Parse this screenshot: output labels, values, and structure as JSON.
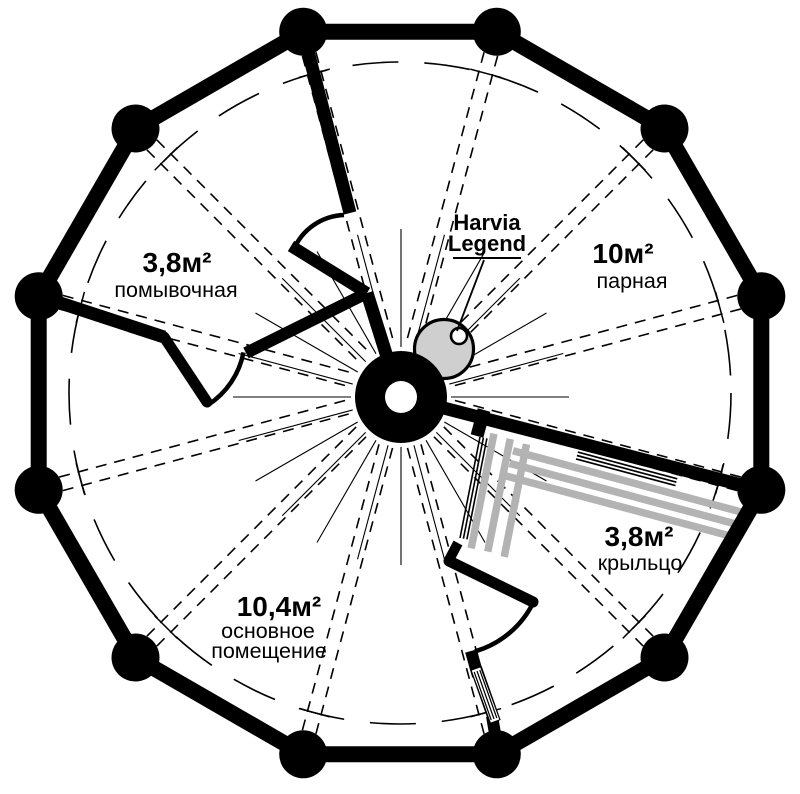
{
  "figure_title": "Round log sauna floor plan",
  "colors": {
    "wall": "#000000",
    "background": "#ffffff",
    "railing_stripe": "#b3b3b3",
    "stove_fill": "#cfcfcf"
  },
  "rooms": {
    "washroom": {
      "area": "3,8м²",
      "name": "помывочная"
    },
    "steam": {
      "area": "10м²",
      "name": "парная"
    },
    "porch": {
      "area": "3,8м²",
      "name": "крыльцо"
    },
    "main": {
      "area": "10,4м²",
      "name_line1": "основное",
      "name_line2": "помещение"
    }
  },
  "heater": {
    "line1": "Harvia",
    "line2": "Legend"
  }
}
